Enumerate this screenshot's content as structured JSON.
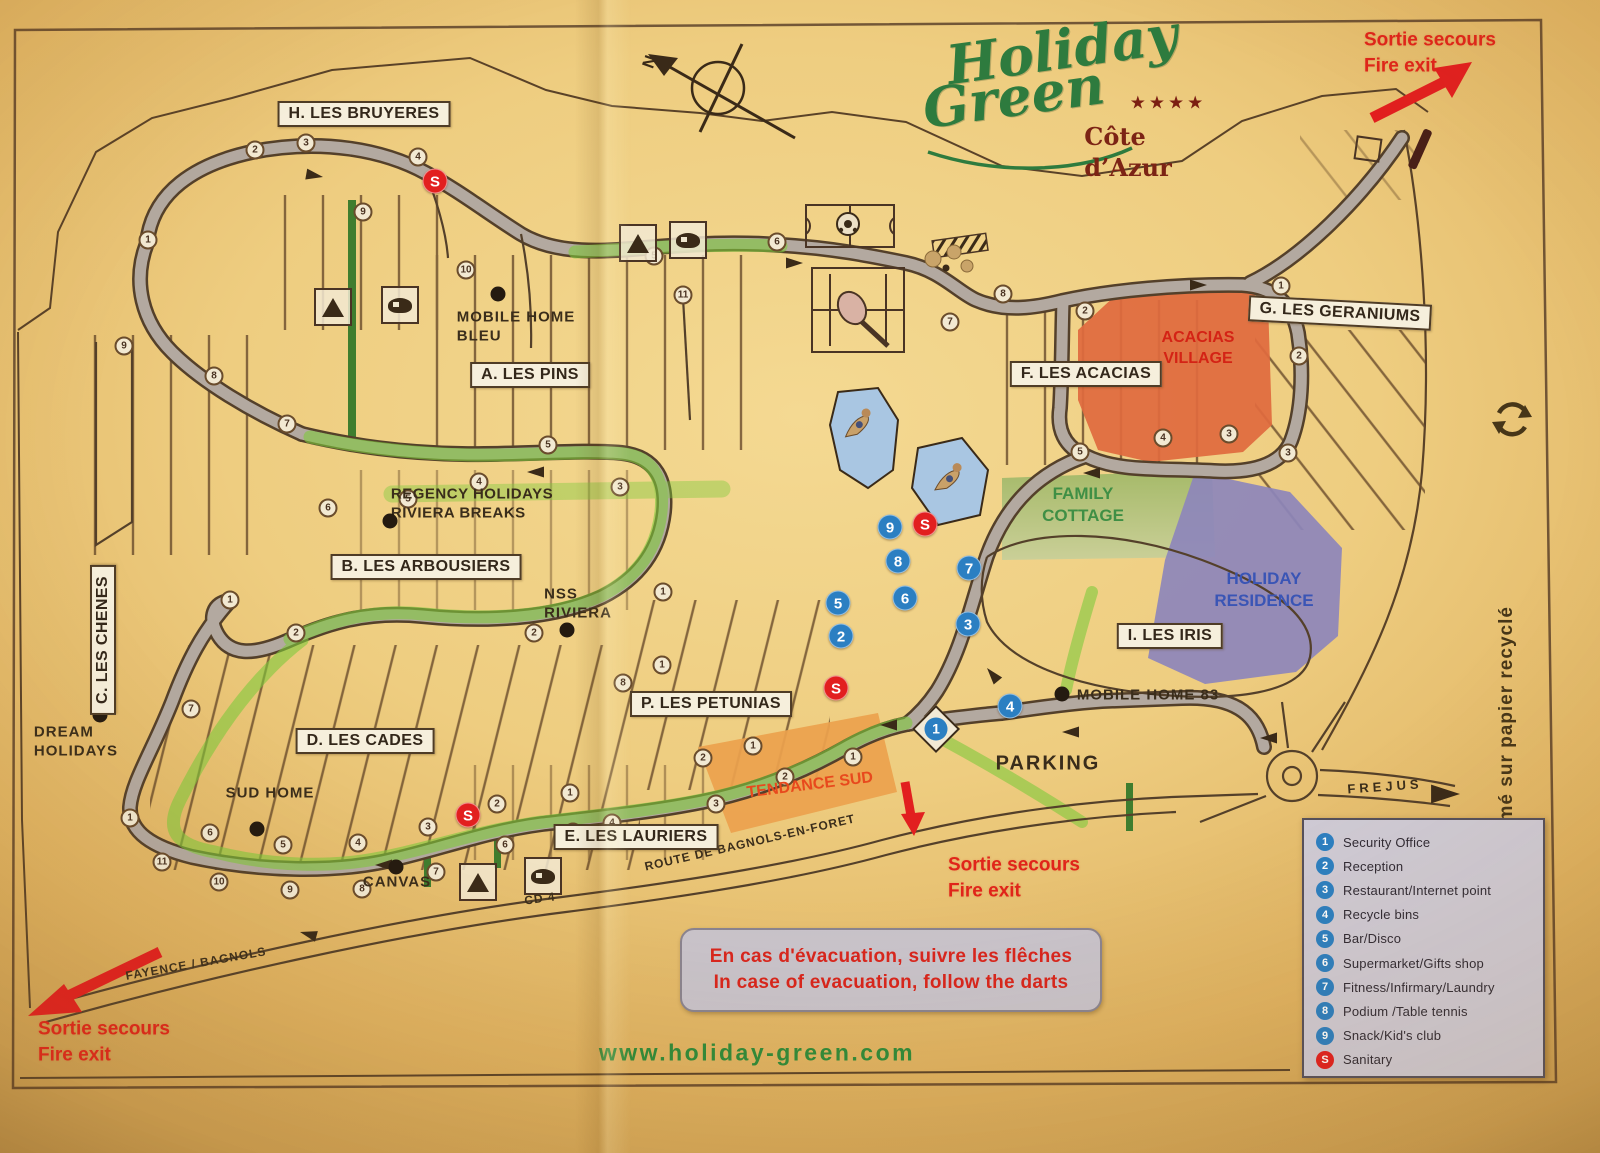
{
  "logo": {
    "line1": "Holiday",
    "line2": "Green",
    "stars": "★★★★",
    "region": "Côte\nd’Azur"
  },
  "compass_label": "N",
  "website": "www.holiday-green.com",
  "recycle_note": "Imprimé sur papier recyclé",
  "fire_exit": {
    "line1": "Sortie secours",
    "line2": "Fire exit"
  },
  "evacuation": {
    "line1": "En cas d'évacuation, suivre les flêches",
    "line2": "In case of evacuation, follow the darts"
  },
  "colors": {
    "facility": "#2b7fc2",
    "sanitary": "#e21f1f",
    "acacias_area": "#e06a3e",
    "family_area": "#a3ba68",
    "residence_area": "#8d86bb",
    "tendance_area": "#eca14e",
    "route_highlight": "#7fca3c",
    "logo_green": "#2e7b3e",
    "fire_red": "#e0251a"
  },
  "zones": [
    {
      "label": "H. LES BRUYERES",
      "x": 364,
      "y": 114,
      "rot": 0
    },
    {
      "label": "A. LES PINS",
      "x": 530,
      "y": 375,
      "rot": 0
    },
    {
      "label": "B. LES ARBOUSIERS",
      "x": 426,
      "y": 567,
      "rot": 0
    },
    {
      "label": "C. LES CHENES",
      "x": 103,
      "y": 640,
      "rot": -90
    },
    {
      "label": "D. LES CADES",
      "x": 365,
      "y": 741,
      "rot": 0
    },
    {
      "label": "E. LES LAURIERS",
      "x": 636,
      "y": 837,
      "rot": 0
    },
    {
      "label": "F. LES ACACIAS",
      "x": 1086,
      "y": 374,
      "rot": 0
    },
    {
      "label": "G. LES GERANIUMS",
      "x": 1340,
      "y": 313,
      "rot": 3
    },
    {
      "label": "I. LES IRIS",
      "x": 1170,
      "y": 636,
      "rot": 0
    },
    {
      "label": "P. LES PETUNIAS",
      "x": 711,
      "y": 704,
      "rot": 0
    }
  ],
  "map_labels": [
    {
      "text": "MOBILE HOME\nBLEU",
      "x": 516,
      "y": 327,
      "size": 15,
      "rot": 0,
      "ls": 1
    },
    {
      "text": "REGENCY HOLIDAYS\nRIVIERA BREAKS",
      "x": 472,
      "y": 504,
      "size": 15,
      "rot": 0,
      "ls": 0.5
    },
    {
      "text": "NSS\nRIVIERA",
      "x": 578,
      "y": 604,
      "size": 15,
      "rot": 0,
      "ls": 1
    },
    {
      "text": "DREAM\nHOLIDAYS",
      "x": 76,
      "y": 742,
      "size": 15,
      "rot": 0,
      "ls": 1
    },
    {
      "text": "SUD HOME",
      "x": 270,
      "y": 794,
      "size": 15,
      "rot": 0,
      "ls": 1
    },
    {
      "text": "CANVAS",
      "x": 397,
      "y": 883,
      "size": 15,
      "rot": 0,
      "ls": 1
    },
    {
      "text": "MOBILE HOME 83",
      "x": 1148,
      "y": 696,
      "size": 15,
      "rot": 0,
      "ls": 1
    },
    {
      "text": "PARKING",
      "x": 1048,
      "y": 764,
      "size": 20,
      "rot": 0,
      "ls": 2
    },
    {
      "text": "FREJUS",
      "x": 1385,
      "y": 787,
      "size": 13,
      "rot": -4,
      "ls": 4
    },
    {
      "text": "FAYENCE / BAGNOLS",
      "x": 196,
      "y": 964,
      "size": 12,
      "rot": -10,
      "ls": 1
    },
    {
      "text": "ROUTE DE BAGNOLS-EN-FORET",
      "x": 750,
      "y": 843,
      "size": 12,
      "rot": -13,
      "ls": 1
    },
    {
      "text": "CD 4",
      "x": 540,
      "y": 899,
      "size": 12,
      "rot": -8,
      "ls": 1
    }
  ],
  "area_labels": [
    {
      "text": "ACACIAS\nVILLAGE",
      "x": 1198,
      "y": 349,
      "size": 16,
      "color": "#d42315",
      "rot": 0
    },
    {
      "text": "FAMILY\nCOTTAGE",
      "x": 1083,
      "y": 505,
      "size": 17,
      "color": "#3f8f45",
      "rot": 0
    },
    {
      "text": "HOLIDAY\nRESIDENCE",
      "x": 1264,
      "y": 590,
      "size": 17,
      "color": "#3a55b5",
      "rot": 0
    },
    {
      "text": "TENDANCE SUD",
      "x": 810,
      "y": 786,
      "size": 16,
      "color": "#e8491d",
      "rot": -7
    }
  ],
  "fire_exits": [
    {
      "x": 1430,
      "y": 53
    },
    {
      "x": 104,
      "y": 1042
    },
    {
      "x": 1014,
      "y": 878
    }
  ],
  "legend": {
    "items": [
      {
        "symbol": "1",
        "label": "Security Office",
        "color": "#2b7fc2"
      },
      {
        "symbol": "2",
        "label": "Reception",
        "color": "#2b7fc2"
      },
      {
        "symbol": "3",
        "label": "Restaurant/Internet point",
        "color": "#2b7fc2"
      },
      {
        "symbol": "4",
        "label": "Recycle bins",
        "color": "#2b7fc2"
      },
      {
        "symbol": "5",
        "label": "Bar/Disco",
        "color": "#2b7fc2"
      },
      {
        "symbol": "6",
        "label": "Supermarket/Gifts shop",
        "color": "#2b7fc2"
      },
      {
        "symbol": "7",
        "label": "Fitness/Infirmary/Laundry",
        "color": "#2b7fc2"
      },
      {
        "symbol": "8",
        "label": "Podium /Table tennis",
        "color": "#2b7fc2"
      },
      {
        "symbol": "9",
        "label": "Snack/Kid's club",
        "color": "#2b7fc2"
      },
      {
        "symbol": "S",
        "label": "Sanitary",
        "color": "#e21f1f"
      }
    ]
  },
  "facility_markers": [
    {
      "x": 890,
      "y": 527,
      "n": "9"
    },
    {
      "x": 898,
      "y": 561,
      "n": "8"
    },
    {
      "x": 905,
      "y": 598,
      "n": "6"
    },
    {
      "x": 838,
      "y": 603,
      "n": "5"
    },
    {
      "x": 841,
      "y": 636,
      "n": "2"
    },
    {
      "x": 969,
      "y": 568,
      "n": "7"
    },
    {
      "x": 968,
      "y": 624,
      "n": "3"
    },
    {
      "x": 1010,
      "y": 706,
      "n": "4"
    }
  ],
  "entrance_marker": {
    "x": 936,
    "y": 729,
    "n": "1"
  },
  "sanitary_symbol": "S",
  "sanitary_markers": [
    {
      "x": 435,
      "y": 181
    },
    {
      "x": 925,
      "y": 524
    },
    {
      "x": 836,
      "y": 688
    },
    {
      "x": 468,
      "y": 815
    }
  ],
  "road_markers": [
    {
      "x": 148,
      "y": 240,
      "n": "1"
    },
    {
      "x": 255,
      "y": 150,
      "n": "2"
    },
    {
      "x": 306,
      "y": 143,
      "n": "3"
    },
    {
      "x": 418,
      "y": 157,
      "n": "4"
    },
    {
      "x": 363,
      "y": 212,
      "n": "9"
    },
    {
      "x": 466,
      "y": 270,
      "n": "10"
    },
    {
      "x": 683,
      "y": 295,
      "n": "11"
    },
    {
      "x": 654,
      "y": 256,
      "n": "5"
    },
    {
      "x": 777,
      "y": 242,
      "n": "6"
    },
    {
      "x": 124,
      "y": 346,
      "n": "9"
    },
    {
      "x": 214,
      "y": 376,
      "n": "8"
    },
    {
      "x": 287,
      "y": 424,
      "n": "7"
    },
    {
      "x": 328,
      "y": 508,
      "n": "6"
    },
    {
      "x": 408,
      "y": 499,
      "n": "5"
    },
    {
      "x": 479,
      "y": 482,
      "n": "4"
    },
    {
      "x": 548,
      "y": 445,
      "n": "5"
    },
    {
      "x": 620,
      "y": 487,
      "n": "3"
    },
    {
      "x": 534,
      "y": 633,
      "n": "2"
    },
    {
      "x": 663,
      "y": 592,
      "n": "1"
    },
    {
      "x": 230,
      "y": 600,
      "n": "1"
    },
    {
      "x": 296,
      "y": 633,
      "n": "2"
    },
    {
      "x": 191,
      "y": 709,
      "n": "7"
    },
    {
      "x": 130,
      "y": 818,
      "n": "1"
    },
    {
      "x": 210,
      "y": 833,
      "n": "6"
    },
    {
      "x": 283,
      "y": 845,
      "n": "5"
    },
    {
      "x": 358,
      "y": 843,
      "n": "4"
    },
    {
      "x": 428,
      "y": 827,
      "n": "3"
    },
    {
      "x": 497,
      "y": 804,
      "n": "2"
    },
    {
      "x": 505,
      "y": 845,
      "n": "6"
    },
    {
      "x": 162,
      "y": 862,
      "n": "11"
    },
    {
      "x": 219,
      "y": 882,
      "n": "10"
    },
    {
      "x": 290,
      "y": 890,
      "n": "9"
    },
    {
      "x": 362,
      "y": 889,
      "n": "8"
    },
    {
      "x": 436,
      "y": 872,
      "n": "7"
    },
    {
      "x": 570,
      "y": 793,
      "n": "1"
    },
    {
      "x": 573,
      "y": 832,
      "n": "5"
    },
    {
      "x": 612,
      "y": 823,
      "n": "4"
    },
    {
      "x": 716,
      "y": 804,
      "n": "3"
    },
    {
      "x": 662,
      "y": 665,
      "n": "1"
    },
    {
      "x": 623,
      "y": 683,
      "n": "8"
    },
    {
      "x": 703,
      "y": 758,
      "n": "2"
    },
    {
      "x": 753,
      "y": 746,
      "n": "1"
    },
    {
      "x": 785,
      "y": 777,
      "n": "2"
    },
    {
      "x": 853,
      "y": 757,
      "n": "1"
    },
    {
      "x": 1003,
      "y": 294,
      "n": "8"
    },
    {
      "x": 1085,
      "y": 311,
      "n": "2"
    },
    {
      "x": 1281,
      "y": 286,
      "n": "1"
    },
    {
      "x": 1299,
      "y": 356,
      "n": "2"
    },
    {
      "x": 1163,
      "y": 438,
      "n": "4"
    },
    {
      "x": 1229,
      "y": 434,
      "n": "3"
    },
    {
      "x": 1080,
      "y": 452,
      "n": "5"
    },
    {
      "x": 1288,
      "y": 453,
      "n": "3"
    },
    {
      "x": 950,
      "y": 322,
      "n": "7"
    }
  ],
  "black_dots": [
    {
      "x": 498,
      "y": 294
    },
    {
      "x": 390,
      "y": 521
    },
    {
      "x": 567,
      "y": 630
    },
    {
      "x": 100,
      "y": 715
    },
    {
      "x": 257,
      "y": 829
    },
    {
      "x": 396,
      "y": 867
    },
    {
      "x": 1062,
      "y": 694
    }
  ]
}
